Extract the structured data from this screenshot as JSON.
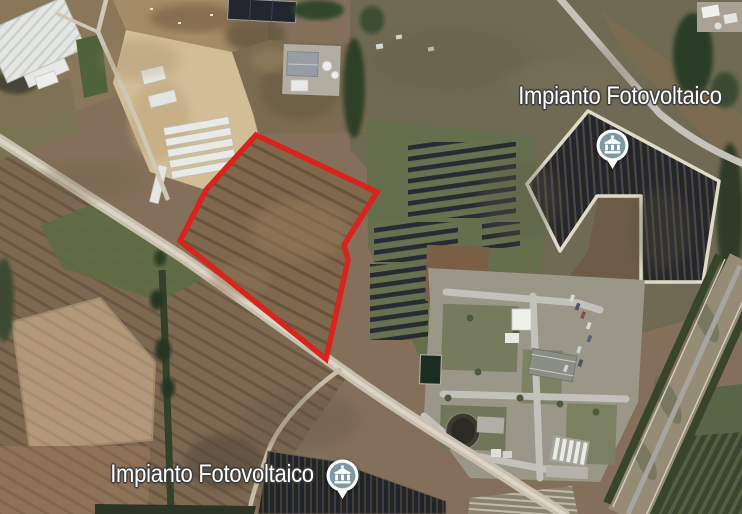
{
  "map": {
    "view": "satellite-aerial",
    "labels": {
      "top": {
        "text": "Impianto Fotovoltaico"
      },
      "bottom": {
        "text": "Impianto Fotovoltaico"
      }
    },
    "markers": {
      "top": {
        "name": "photovoltaic-plant-marker-north",
        "icon": "classical-building-icon"
      },
      "bottom": {
        "name": "photovoltaic-plant-marker-south",
        "icon": "classical-building-icon"
      }
    },
    "colors": {
      "parcel_outline": "#d8241c",
      "marker_fill": "#7e99a1",
      "marker_ring": "#ffffff",
      "label_text": "#ffffff",
      "label_outline": "#3e3e3e"
    }
  }
}
